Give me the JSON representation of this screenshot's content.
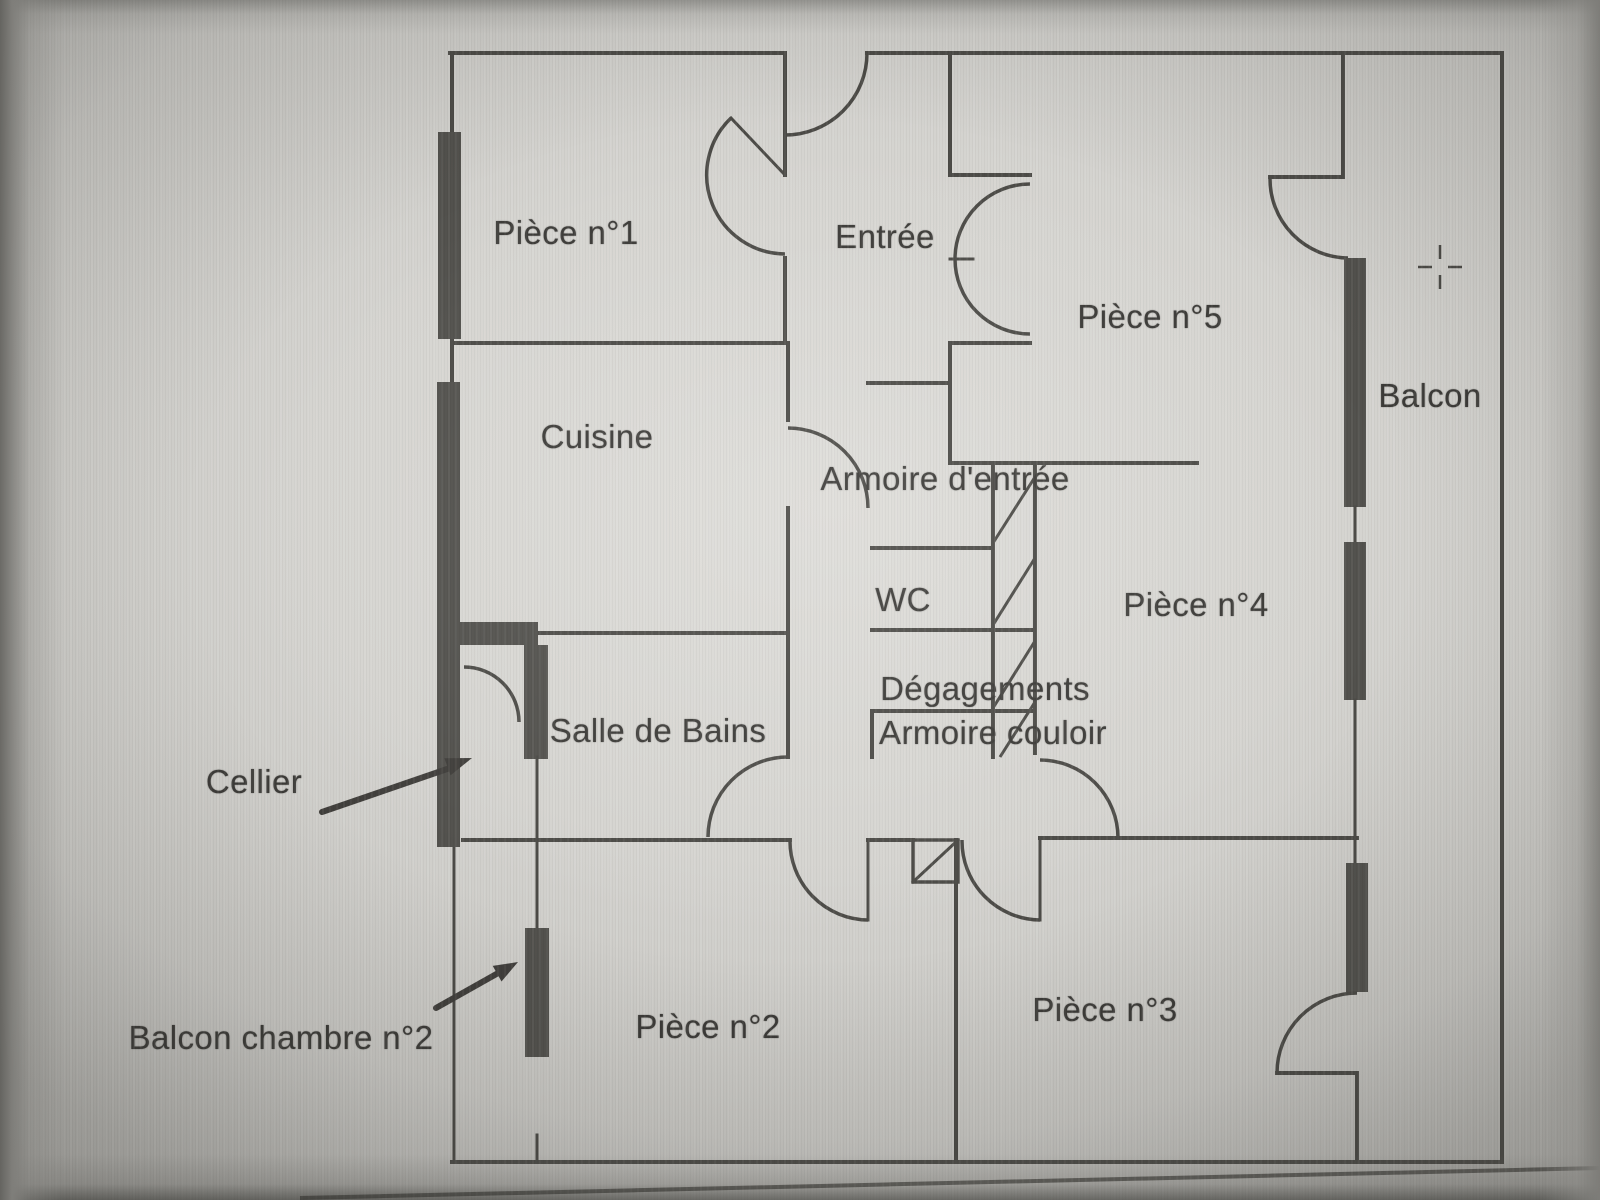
{
  "floor_plan": {
    "labels": {
      "piece1": "Pièce n°1",
      "entree": "Entrée",
      "piece5": "Pièce n°5",
      "balcon": "Balcon",
      "cuisine": "Cuisine",
      "armoire_entree": "Armoire d'entrée",
      "wc": "WC",
      "piece4": "Pièce n°4",
      "degagements": "Dégagements",
      "armoire_couloir": "Armoire couloir",
      "salle_de_bains": "Salle de Bains",
      "cellier": "Cellier",
      "balcon_chambre2": "Balcon chambre n°2",
      "piece2": "Pièce n°2",
      "piece3": "Pièce n°3"
    },
    "colors": {
      "wall_line": "#4c4b47",
      "label_text": "#3c3b38",
      "paper": "#d5d4d0"
    }
  }
}
